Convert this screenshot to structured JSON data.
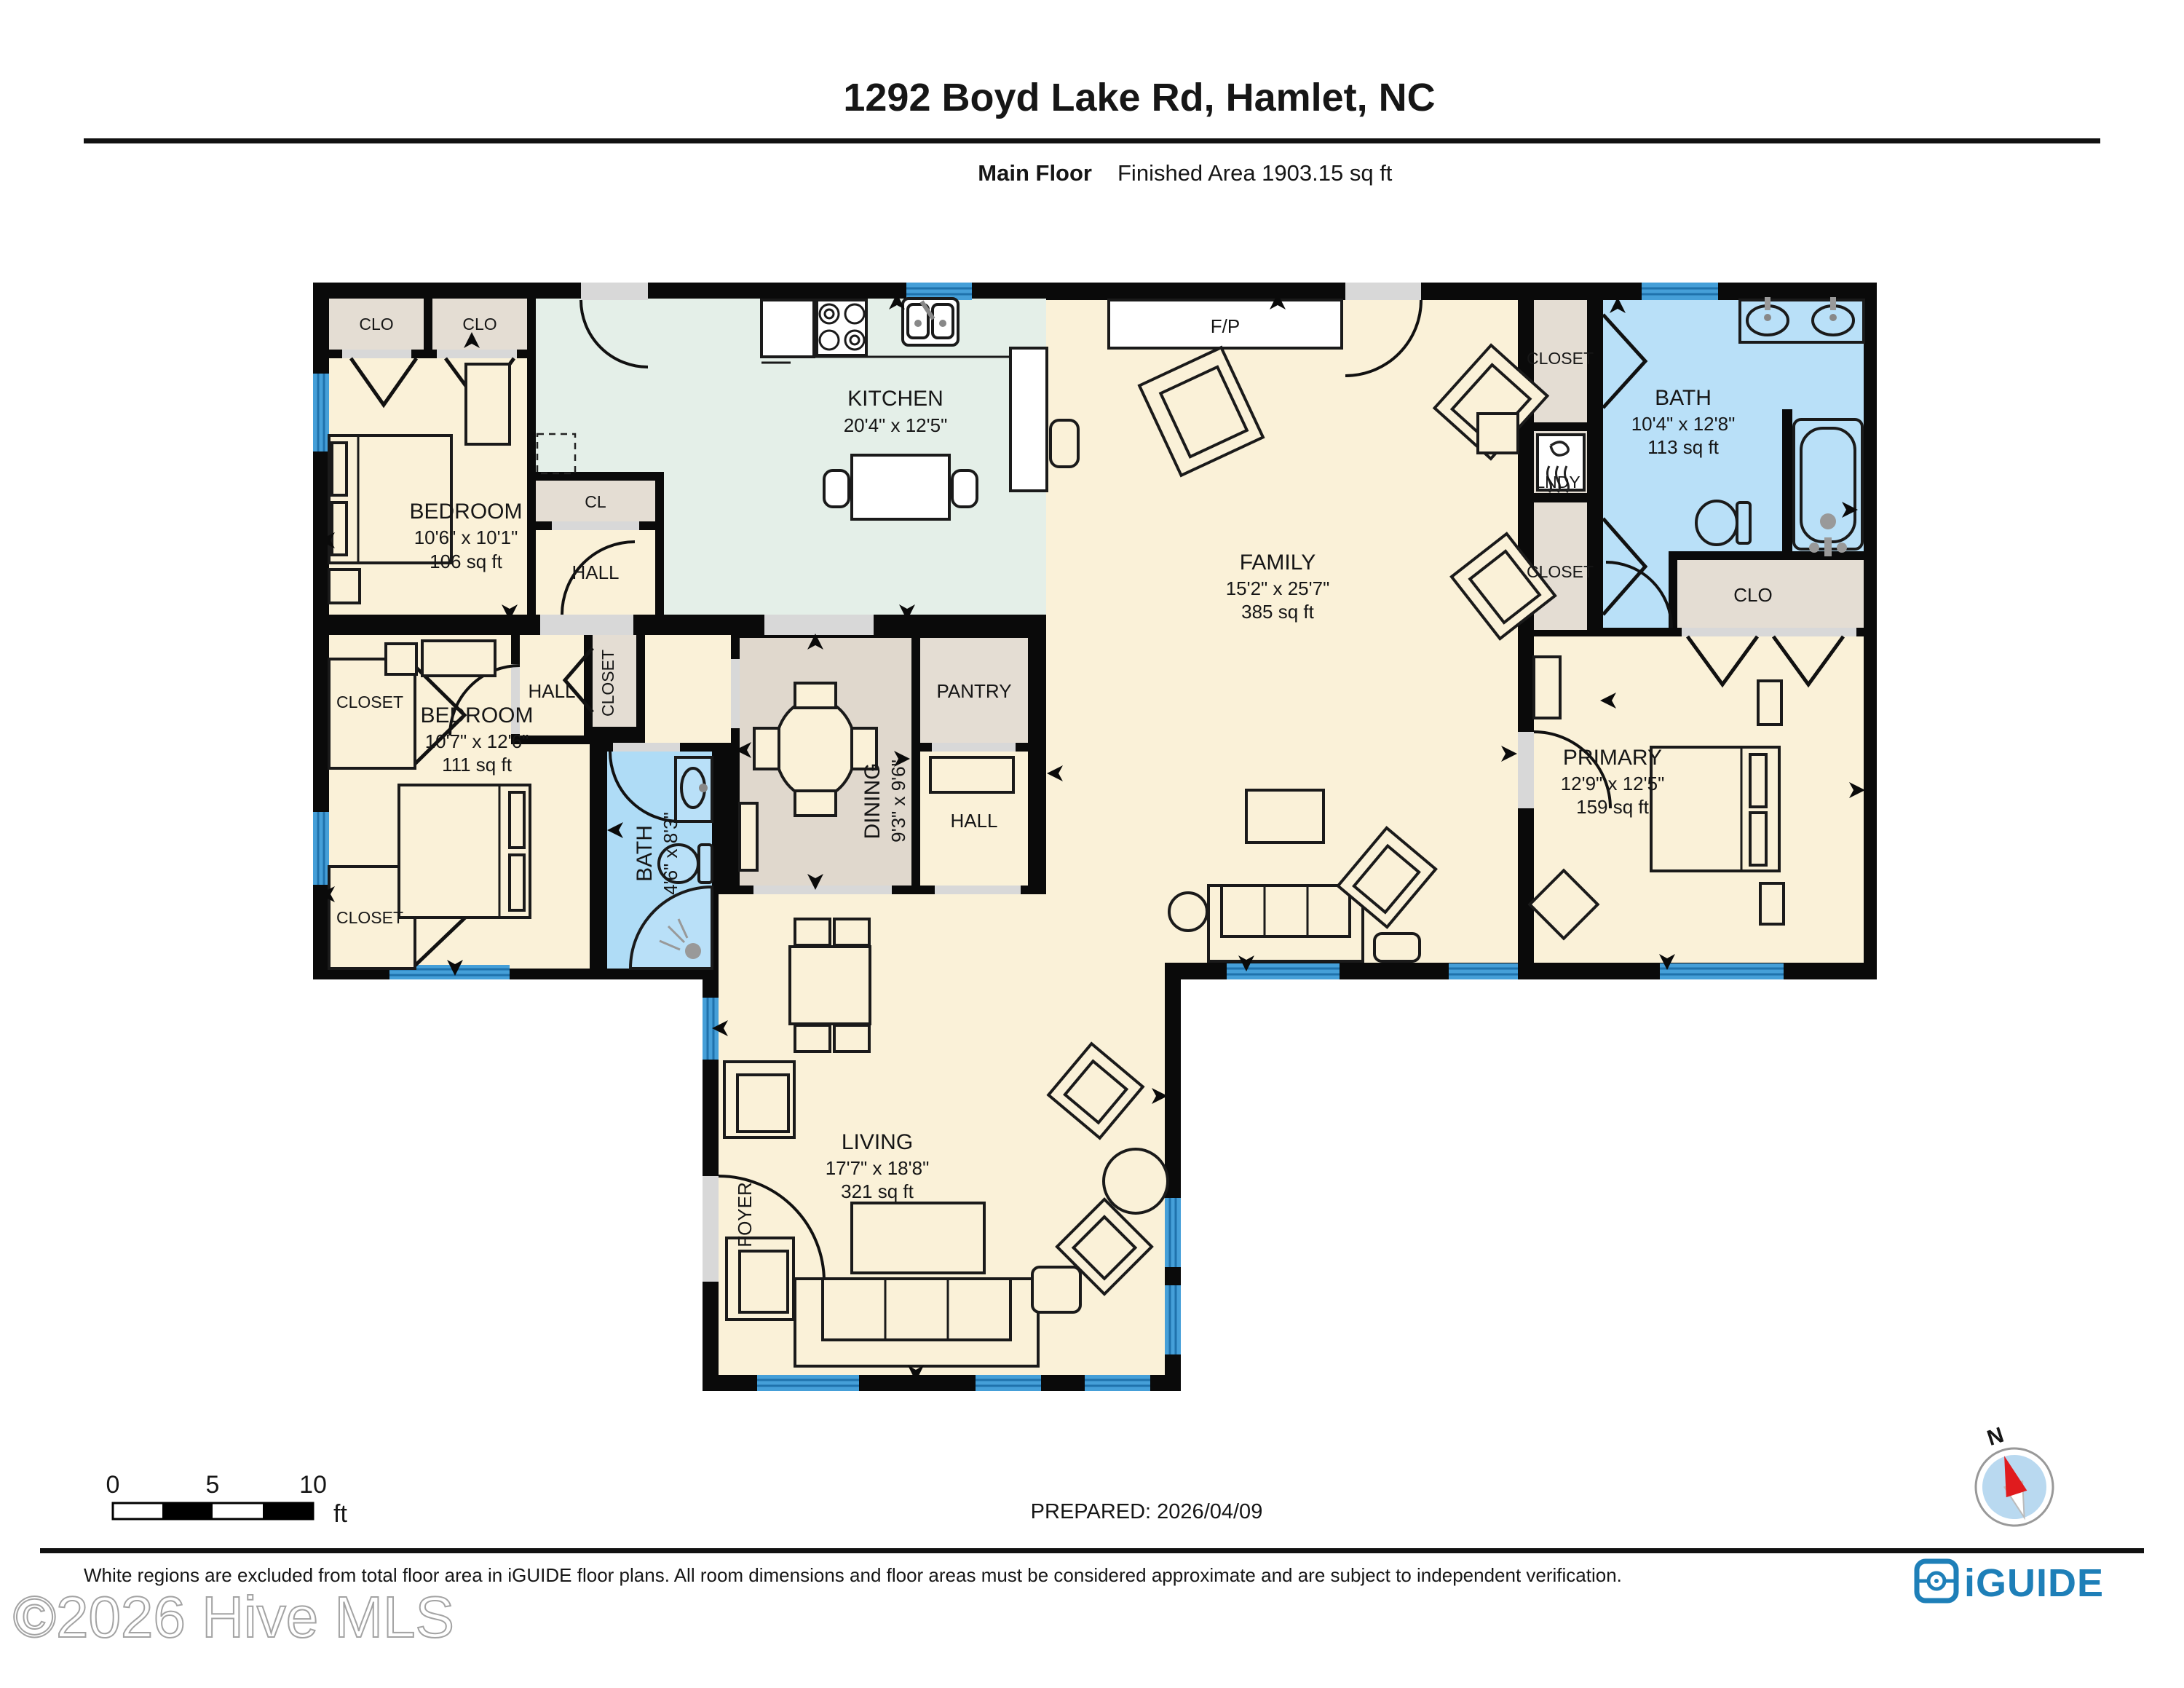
{
  "header": {
    "title": "1292 Boyd Lake Rd, Hamlet, NC",
    "floor_label": "Main Floor",
    "area_label": "Finished Area 1903.15 sq ft"
  },
  "rooms": {
    "kitchen": {
      "name": "KITCHEN",
      "dims": "20'4\" x 12'5\""
    },
    "family": {
      "name": "FAMILY",
      "dims": "15'2\" x 25'7\"",
      "area": "385 sq ft"
    },
    "living": {
      "name": "LIVING",
      "dims": "17'7\" x 18'8\"",
      "area": "321 sq ft"
    },
    "dining": {
      "name": "DINING",
      "dims": "9'3\" x 9'6\""
    },
    "primary": {
      "name": "PRIMARY",
      "dims": "12'9\" x 12'5\"",
      "area": "159 sq ft"
    },
    "bedroom_front": {
      "name": "BEDROOM",
      "dims": "10'6\" x 10'1\"",
      "area": "106 sq ft"
    },
    "bedroom_back": {
      "name": "BEDROOM",
      "dims": "10'7\" x 12'6\"",
      "area": "111 sq ft"
    },
    "bath_main": {
      "name": "BATH",
      "dims": "10'4\" x 12'8\"",
      "area": "113 sq ft"
    },
    "bath_hall": {
      "name": "BATH",
      "dims": "4'6\" x 8'3\""
    },
    "pantry": {
      "name": "PANTRY"
    },
    "hall": {
      "name": "HALL"
    },
    "foyer": {
      "name": "FOYER"
    },
    "laundry": {
      "name": "LNDY"
    },
    "fireplace": {
      "name": "F/P"
    },
    "closet": {
      "name": "CLOSET"
    },
    "closet_small": {
      "name": "CLO"
    },
    "closet_cl": {
      "name": "CL"
    }
  },
  "scale_bar": {
    "t0": "0",
    "t5": "5",
    "t10": "10",
    "unit": "ft"
  },
  "prepared": {
    "label": "PREPARED: 2026/04/09"
  },
  "compass": {
    "north": "N"
  },
  "footer": {
    "disclaimer": "White regions are excluded from total floor area in iGUIDE floor plans. All room dimensions and floor areas must be considered approximate and are subject to independent verification.",
    "brand": "iGUIDE",
    "watermark": "©2026 Hive MLS"
  },
  "colors": {
    "wall": "#0a0a0a",
    "room_beige": "#FAF1D8",
    "kitchen_teal": "#E4EFE8",
    "closet_gray": "#E4DDD3",
    "bath_blue": "#B9E0F8",
    "window_blue": "#459FD8",
    "brand_blue": "#1E7FB8",
    "compass_red": "#E01B1E"
  }
}
